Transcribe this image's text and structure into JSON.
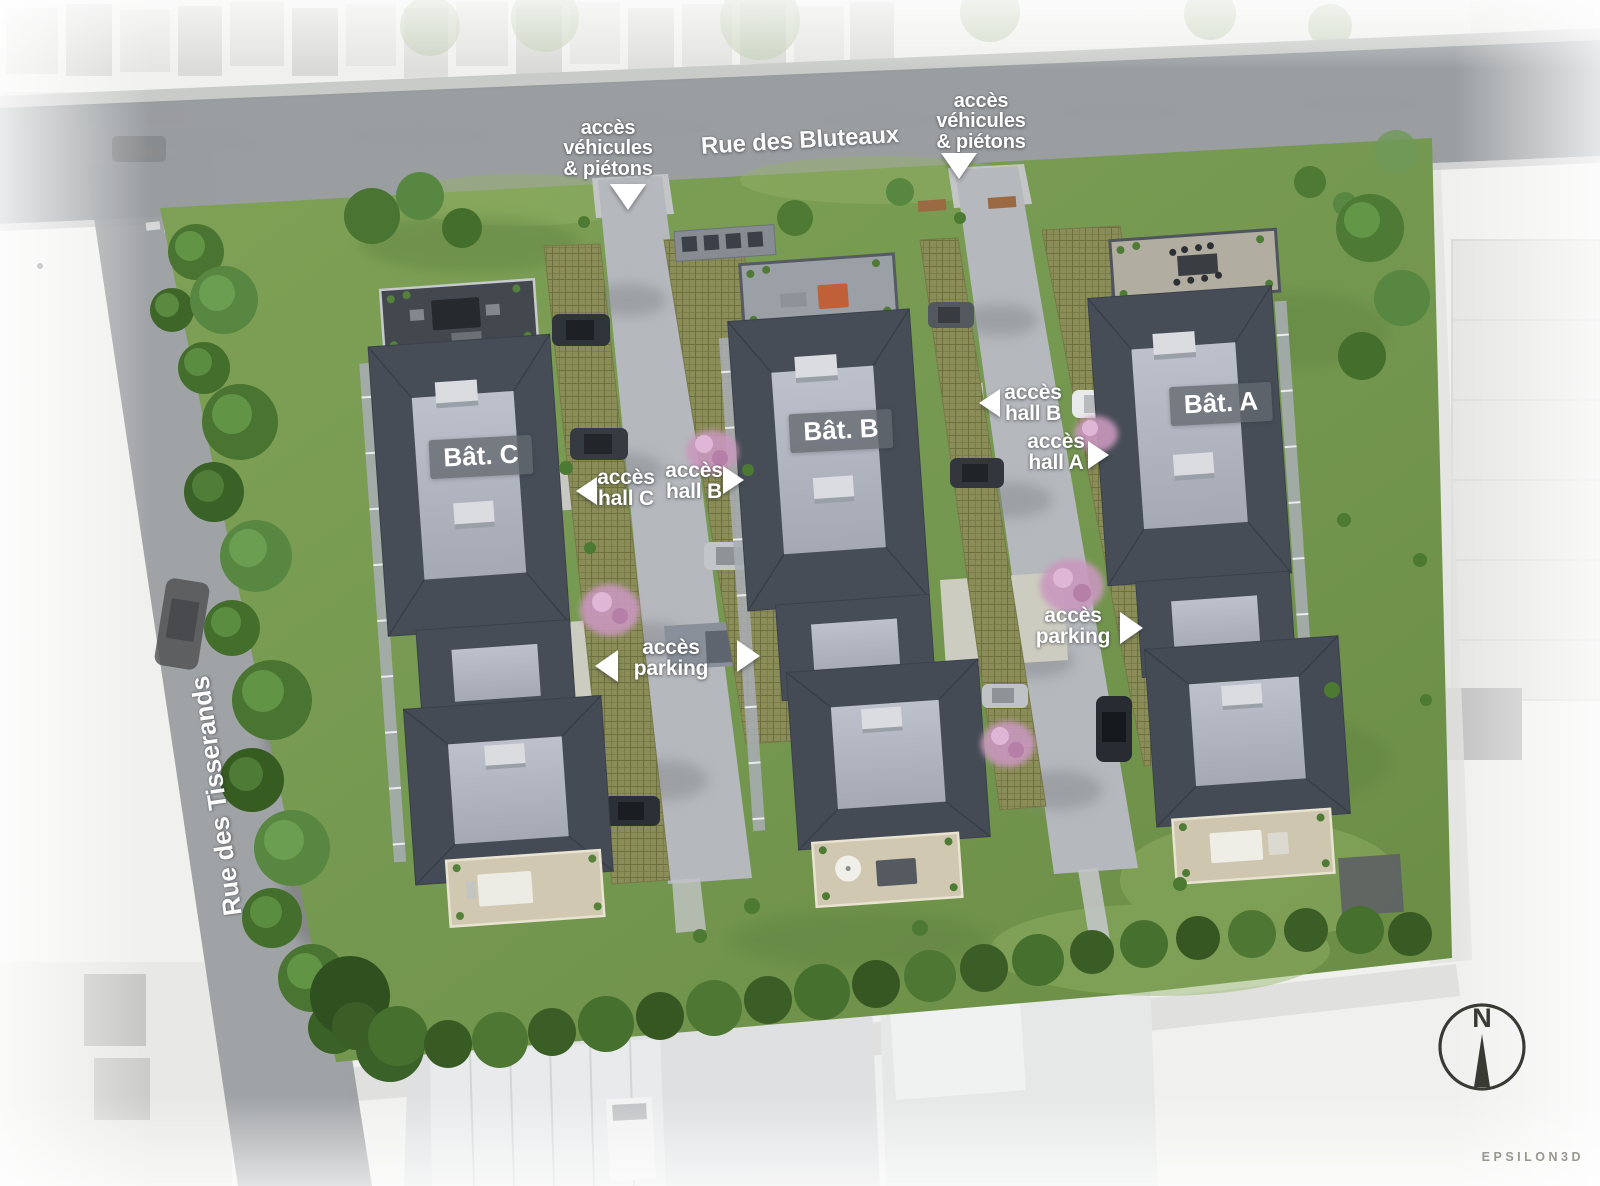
{
  "streets": {
    "top": "Rue des Bluteaux",
    "left": "Rue des Tisserands"
  },
  "buildings": {
    "a": {
      "label": "Bât. A"
    },
    "b": {
      "label": "Bât. B"
    },
    "c": {
      "label": "Bât. C"
    }
  },
  "annotations": {
    "vehicles_left": {
      "lines": [
        "accès",
        "véhicules",
        "& piétons"
      ],
      "arrow": "down"
    },
    "vehicles_right": {
      "lines": [
        "accès",
        "véhicules",
        "& piétons"
      ],
      "arrow": "down"
    },
    "hall_c": {
      "lines": [
        "accès",
        "hall C"
      ],
      "arrow": "left"
    },
    "hall_b_center": {
      "lines": [
        "accès",
        "hall B"
      ],
      "arrow": "right"
    },
    "hall_b_right": {
      "lines": [
        "accès",
        "hall B"
      ],
      "arrow": "left"
    },
    "hall_a": {
      "lines": [
        "accès",
        "hall A"
      ],
      "arrow": "right"
    },
    "parking_left": {
      "lines": [
        "accès",
        "parking"
      ],
      "arrows": [
        "left",
        "right"
      ]
    },
    "parking_right": {
      "lines": [
        "accès",
        "parking"
      ],
      "arrow": "right"
    }
  },
  "compass": {
    "north_label": "N"
  },
  "credit": {
    "studio": "EPSILON3D"
  },
  "colors": {
    "label_text": "#ffffff",
    "badge_background": "#64696f",
    "road_gray": "#95989b",
    "lawn_green": "#789a50",
    "roof_slate": "#474d57",
    "roof_top_light": "#b2b6c0",
    "paver_olive": "#8a8d58",
    "driveway_gray": "#b5b8bc",
    "pink_blossom": "#c998be",
    "terrace_tan": "#d1c8b1",
    "compass_ink": "#3a3a35",
    "credit_gray": "#98988f"
  }
}
